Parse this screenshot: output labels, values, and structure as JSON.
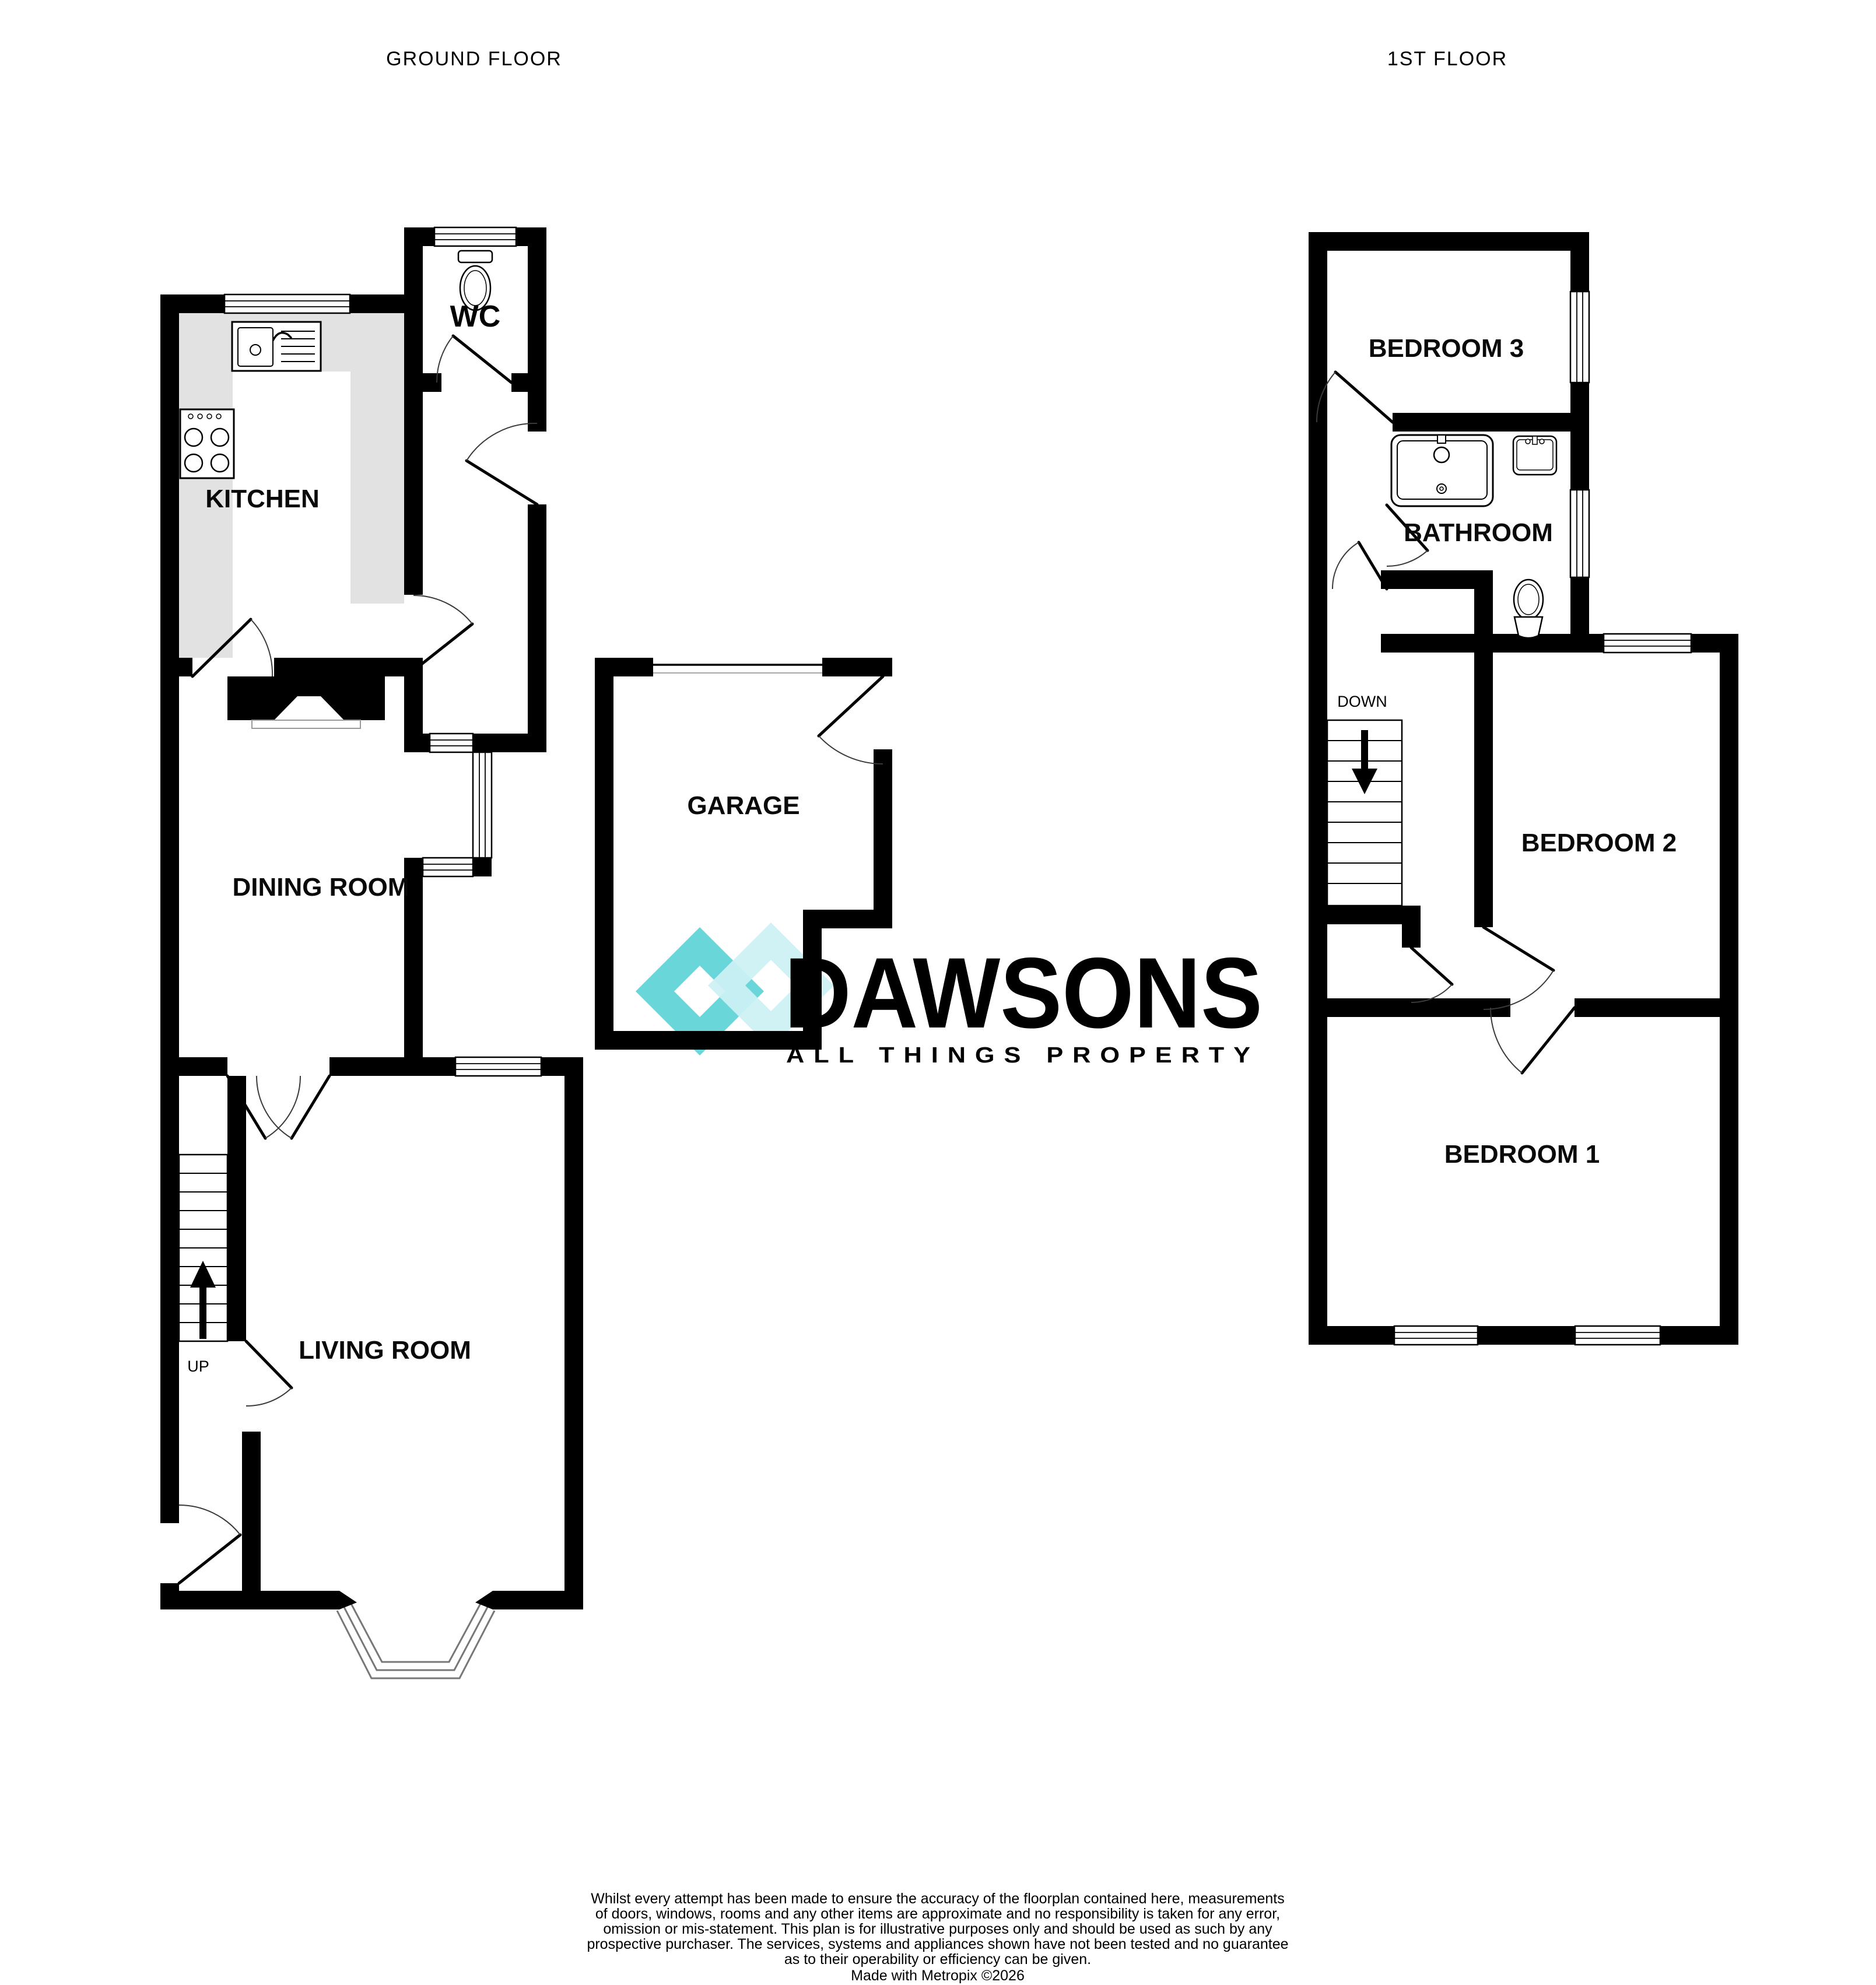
{
  "header": {
    "ground_floor_label": "GROUND FLOOR",
    "first_floor_label": "1ST FLOOR"
  },
  "ground_floor": {
    "kitchen": "KITCHEN",
    "wc": "WC",
    "dining_room": "DINING ROOM",
    "garage": "GARAGE",
    "living_room": "LIVING ROOM",
    "stairs": "UP"
  },
  "first_floor": {
    "bedroom3": "BEDROOM 3",
    "bathroom": "BATHROOM",
    "bedroom2": "BEDROOM 2",
    "bedroom1": "BEDROOM 1",
    "stairs": "DOWN"
  },
  "logo": {
    "brand": "DAWSONS",
    "tagline": "ALL THINGS PROPERTY",
    "brand_color": "#8c8c8c",
    "tagline_color": "#7edde2",
    "diamond_dark": "#69d6da",
    "diamond_light": "#cdf1f4"
  },
  "footer": {
    "disclaimer_lines": [
      "Whilst every attempt has been made to ensure the accuracy of the floorplan contained here, measurements",
      "of doors, windows, rooms and any other items are approximate and no responsibility is taken for any error,",
      "omission or mis-statement. This plan is for illustrative purposes only and should be used as such by any",
      "prospective purchaser. The services, systems and appliances shown have not been tested and no guarantee",
      "as to their operability or efficiency can be given."
    ],
    "credit": "Made with Metropix ©2026"
  },
  "style": {
    "wall_color": "#000000",
    "counter_color": "#e2e2e2",
    "background": "#ffffff"
  }
}
